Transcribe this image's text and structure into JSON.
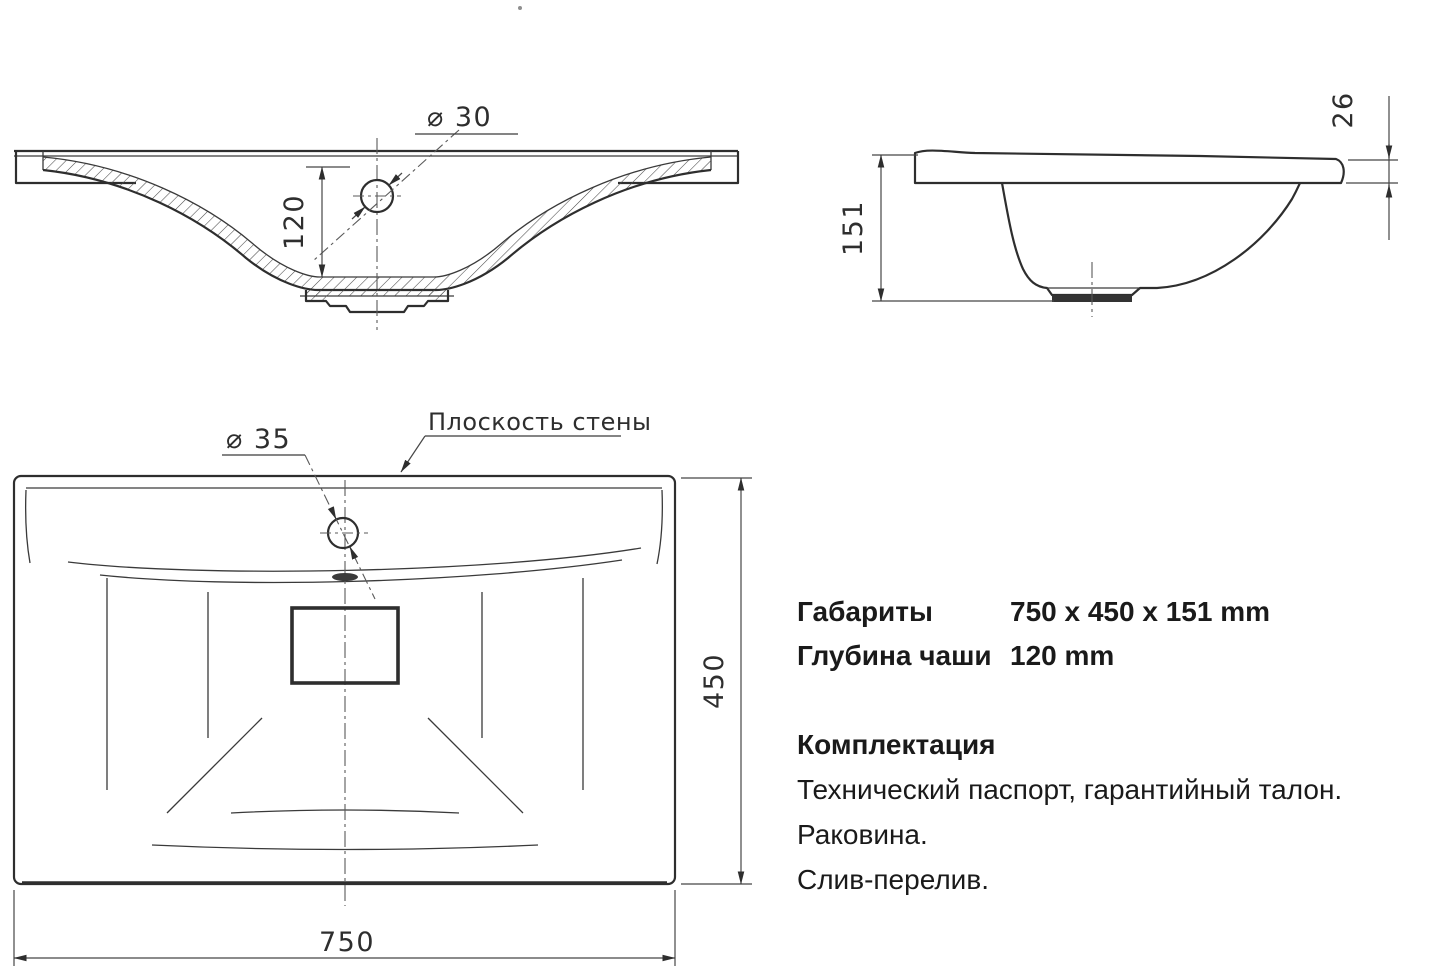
{
  "drawing": {
    "front_view": {
      "faucet_hole_label": "⌀ 30",
      "bowl_depth_dim": "120"
    },
    "side_view": {
      "height_dim": "151",
      "rim_thickness_dim": "26"
    },
    "top_view": {
      "faucet_hole_label": "⌀ 35",
      "wall_plane_label": "Плоскость стены",
      "depth_dim": "450",
      "width_dim": "750"
    }
  },
  "specs": {
    "rows": [
      {
        "label": "Габариты",
        "value": "750 x 450 x 151 mm"
      },
      {
        "label": "Глубина чаши",
        "value": "120 mm"
      }
    ],
    "package_title": "Комплектация",
    "package_items": [
      "Технический паспорт, гарантийный талон.",
      "Раковина.",
      "Слив-перелив."
    ]
  },
  "colors": {
    "line": "#2e2e2e",
    "text": "#1a1a1a",
    "background": "#ffffff"
  }
}
